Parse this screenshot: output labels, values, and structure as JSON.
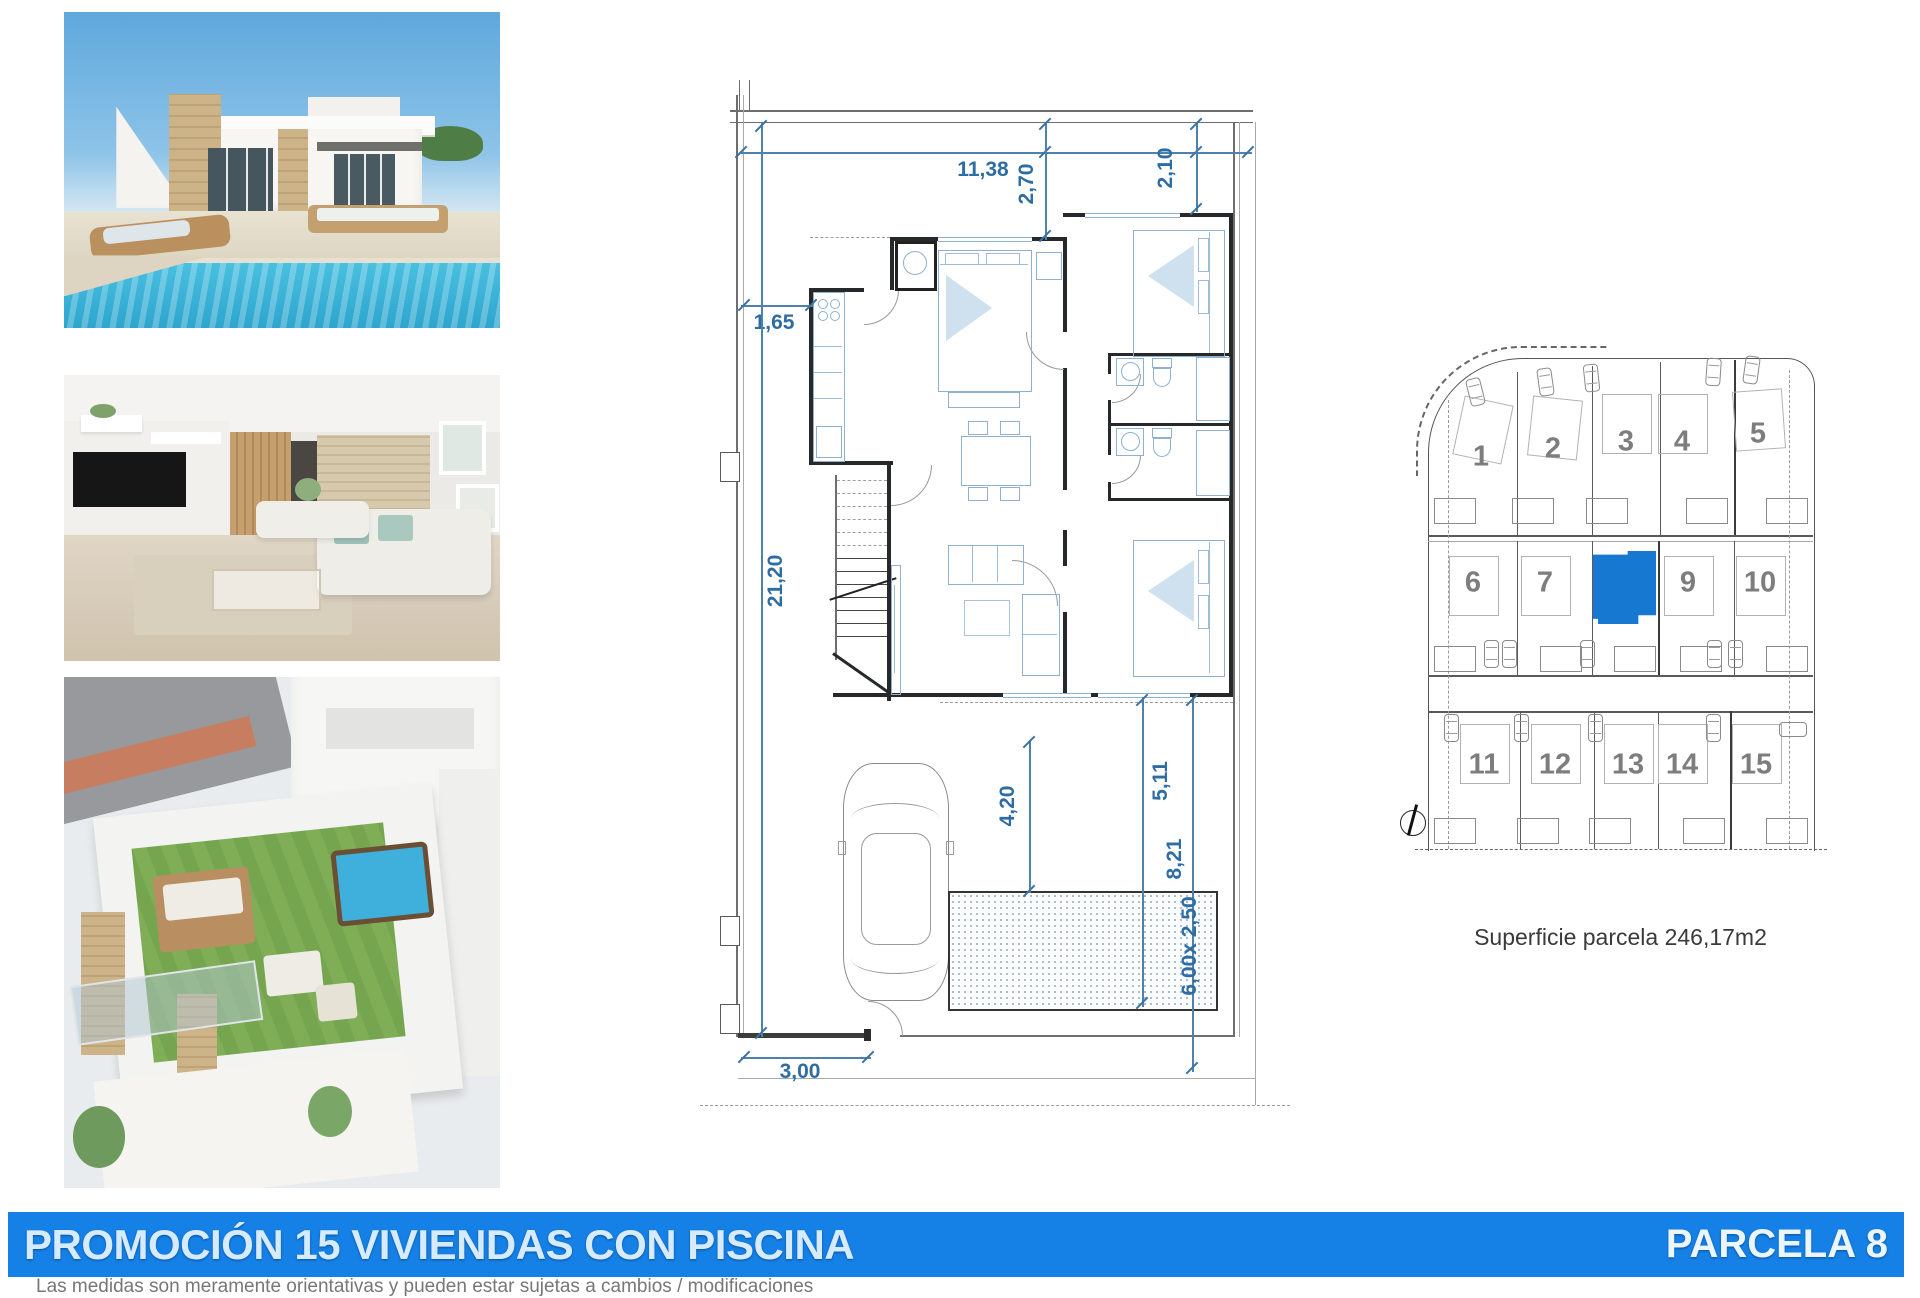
{
  "photos": {
    "villa": {
      "name": "villa-exterior-pool-photo"
    },
    "living": {
      "name": "living-room-interior-photo"
    },
    "rooftop": {
      "name": "rooftop-terrace-photo"
    }
  },
  "floorplan": {
    "dims": {
      "width_top": "11,38",
      "bed1_depth": "2,70",
      "bed2_depth": "2,10",
      "setback_left": "1,65",
      "plot_depth": "21,20",
      "terrace_depth": "4,20",
      "yard_depth_1": "5,11",
      "yard_depth_2": "8,21",
      "pool_size": "6,00x 2,50",
      "gate_width": "3,00"
    }
  },
  "site_map": {
    "parcels": [
      "1",
      "2",
      "3",
      "4",
      "5",
      "6",
      "7",
      "8",
      "9",
      "10",
      "11",
      "12",
      "13",
      "14",
      "15"
    ],
    "highlighted_parcel": "8",
    "highlight_color": "#1778d2",
    "area_note": "Superficie parcela 246,17m2"
  },
  "footer": {
    "banner_color": "#1581e6",
    "title": "PROMOCIÓN 15 VIVIENDAS CON PISCINA",
    "parcel_label": "PARCELA 8",
    "disclaimer": "Las medidas son meramente orientativas y pueden estar sujetas a cambios / modificaciones"
  }
}
